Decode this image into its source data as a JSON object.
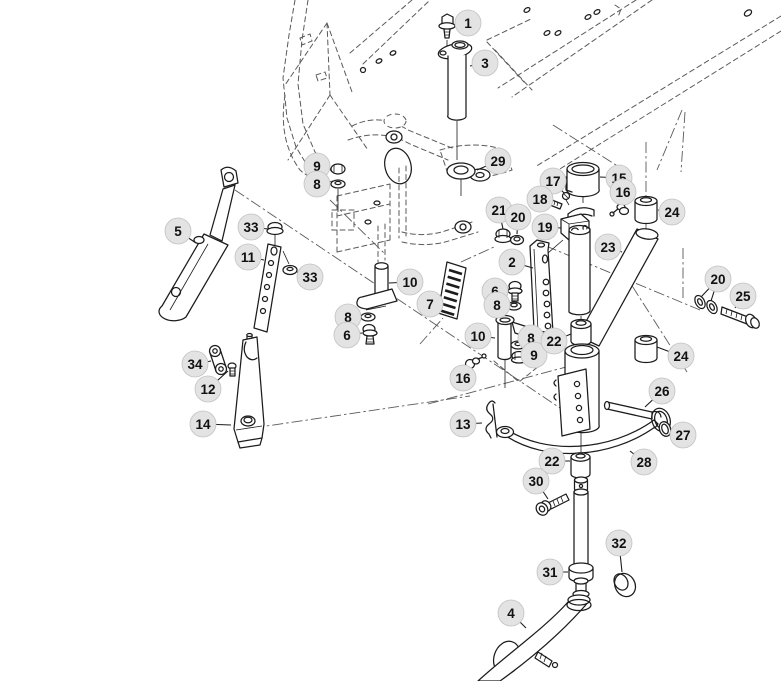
{
  "figure": {
    "type": "exploded-parts-diagram",
    "width": 781,
    "height": 681,
    "background_color": "#ffffff",
    "part_line_color": "#1c1c1c",
    "hidden_line_color": "#5a5a5a",
    "callout": {
      "fill": "#e3e3e3",
      "stroke": "#c2c2c2",
      "text_color": "#111111",
      "radius": 13,
      "font_size": 13.5
    }
  },
  "part_numbers_shown": [
    "1",
    "2",
    "3",
    "4",
    "5",
    "6",
    "7",
    "8",
    "9",
    "10",
    "11",
    "12",
    "13",
    "14",
    "15",
    "16",
    "17",
    "18",
    "19",
    "20",
    "21",
    "22",
    "23",
    "24",
    "25",
    "26",
    "27",
    "28",
    "29",
    "30",
    "31",
    "32",
    "33",
    "34"
  ],
  "callouts": [
    {
      "label": "1",
      "x": 468,
      "y": 23,
      "leads": [
        [
          454,
          25
        ]
      ]
    },
    {
      "label": "3",
      "x": 485,
      "y": 63,
      "leads": [
        [
          470,
          66
        ]
      ]
    },
    {
      "label": "29",
      "x": 498,
      "y": 161,
      "leads": [
        [
          477,
          170
        ]
      ]
    },
    {
      "label": "9",
      "x": 317,
      "y": 166,
      "leads": [
        [
          331,
          169
        ]
      ]
    },
    {
      "label": "8",
      "x": 317,
      "y": 184,
      "leads": [
        [
          330,
          184
        ]
      ]
    },
    {
      "label": "5",
      "x": 178,
      "y": 231,
      "leads": [
        [
          196,
          243
        ]
      ]
    },
    {
      "label": "33",
      "x": 251,
      "y": 227,
      "leads": [
        [
          268,
          229
        ]
      ]
    },
    {
      "label": "11",
      "x": 248,
      "y": 257,
      "leads": [
        [
          264,
          260
        ]
      ]
    },
    {
      "label": "33",
      "x": 310,
      "y": 277,
      "leads": [
        [
          297,
          272
        ]
      ]
    },
    {
      "label": "10",
      "x": 410,
      "y": 282,
      "leads": [
        [
          389,
          283
        ]
      ]
    },
    {
      "label": "7",
      "x": 430,
      "y": 304,
      "leads": [
        [
          445,
          305
        ]
      ]
    },
    {
      "label": "8",
      "x": 348,
      "y": 317,
      "leads": [
        [
          361,
          317
        ]
      ]
    },
    {
      "label": "6",
      "x": 347,
      "y": 335,
      "leads": [
        [
          362,
          333
        ]
      ]
    },
    {
      "label": "17",
      "x": 553,
      "y": 181,
      "leads": [
        [
          564,
          193
        ]
      ]
    },
    {
      "label": "15",
      "x": 619,
      "y": 178,
      "leads": [
        [
          600,
          177
        ]
      ]
    },
    {
      "label": "16",
      "x": 623,
      "y": 192,
      "leads": [
        [
          619,
          203
        ]
      ]
    },
    {
      "label": "18",
      "x": 540,
      "y": 199,
      "leads": [
        [
          550,
          201
        ]
      ]
    },
    {
      "label": "21",
      "x": 499,
      "y": 210,
      "leads": [
        [
          503,
          229
        ]
      ]
    },
    {
      "label": "20",
      "x": 518,
      "y": 217,
      "leads": [
        [
          517,
          234
        ]
      ]
    },
    {
      "label": "19",
      "x": 545,
      "y": 227,
      "leads": [
        [
          561,
          228
        ]
      ]
    },
    {
      "label": "2",
      "x": 512,
      "y": 262,
      "leads": [
        [
          533,
          268
        ]
      ]
    },
    {
      "label": "23",
      "x": 608,
      "y": 247,
      "leads": [
        [
          622,
          252
        ]
      ]
    },
    {
      "label": "24",
      "x": 672,
      "y": 212,
      "leads": [
        [
          658,
          210
        ]
      ]
    },
    {
      "label": "20",
      "x": 718,
      "y": 279,
      "leads": [
        [
          701,
          297
        ],
        [
          711,
          301
        ]
      ]
    },
    {
      "label": "25",
      "x": 743,
      "y": 296,
      "leads": [
        [
          735,
          308
        ]
      ]
    },
    {
      "label": "24",
      "x": 681,
      "y": 356,
      "leads": [
        [
          657,
          347
        ]
      ]
    },
    {
      "label": "6",
      "x": 495,
      "y": 291,
      "leads": [
        [
          509,
          289
        ]
      ]
    },
    {
      "label": "8",
      "x": 497,
      "y": 305,
      "leads": [
        [
          508,
          305
        ]
      ]
    },
    {
      "label": "10",
      "x": 478,
      "y": 336,
      "leads": [
        [
          495,
          338
        ]
      ]
    },
    {
      "label": "8",
      "x": 531,
      "y": 338,
      "leads": [
        [
          520,
          344
        ]
      ]
    },
    {
      "label": "9",
      "x": 534,
      "y": 355,
      "leads": [
        [
          523,
          356
        ]
      ]
    },
    {
      "label": "22",
      "x": 554,
      "y": 341,
      "leads": [
        [
          571,
          334
        ]
      ]
    },
    {
      "label": "16",
      "x": 463,
      "y": 378,
      "leads": [
        [
          470,
          368
        ]
      ]
    },
    {
      "label": "26",
      "x": 662,
      "y": 391,
      "leads": [
        [
          645,
          407
        ]
      ]
    },
    {
      "label": "13",
      "x": 463,
      "y": 424,
      "leads": [
        [
          482,
          423
        ]
      ]
    },
    {
      "label": "27",
      "x": 683,
      "y": 435,
      "leads": [
        [
          670,
          429
        ]
      ]
    },
    {
      "label": "28",
      "x": 644,
      "y": 462,
      "leads": [
        [
          630,
          451
        ]
      ]
    },
    {
      "label": "22",
      "x": 552,
      "y": 461,
      "leads": [
        [
          570,
          461
        ]
      ]
    },
    {
      "label": "30",
      "x": 536,
      "y": 481,
      "leads": [
        [
          548,
          499
        ]
      ]
    },
    {
      "label": "32",
      "x": 619,
      "y": 543,
      "leads": [
        [
          622,
          572
        ]
      ]
    },
    {
      "label": "31",
      "x": 550,
      "y": 572,
      "leads": [
        [
          568,
          572
        ]
      ]
    },
    {
      "label": "4",
      "x": 511,
      "y": 613,
      "leads": [
        [
          526,
          628
        ]
      ]
    },
    {
      "label": "34",
      "x": 195,
      "y": 364,
      "leads": [
        [
          211,
          361
        ]
      ]
    },
    {
      "label": "12",
      "x": 208,
      "y": 389,
      "leads": [
        [
          228,
          371
        ]
      ]
    },
    {
      "label": "14",
      "x": 203,
      "y": 424,
      "leads": [
        [
          231,
          425
        ]
      ]
    }
  ]
}
